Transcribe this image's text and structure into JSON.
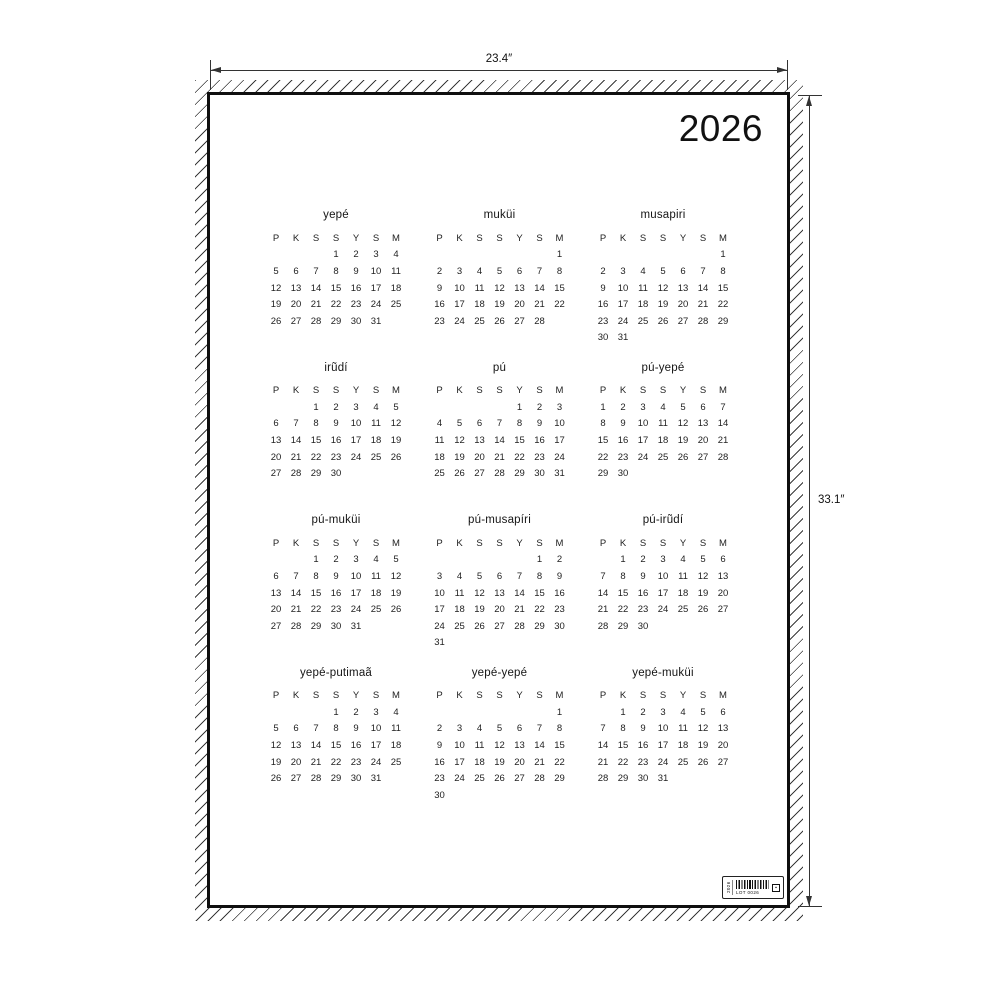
{
  "dimension_annotations": {
    "width_label": "23.4″",
    "height_label": "33.1″"
  },
  "poster": {
    "year": "2026",
    "weekday_headers": [
      "P",
      "K",
      "S",
      "S",
      "Y",
      "S",
      "M"
    ],
    "months": [
      {
        "name": "yepé",
        "weeks": [
          [
            "",
            "",
            "",
            "1",
            "2",
            "3",
            "4"
          ],
          [
            "5",
            "6",
            "7",
            "8",
            "9",
            "10",
            "11"
          ],
          [
            "12",
            "13",
            "14",
            "15",
            "16",
            "17",
            "18"
          ],
          [
            "19",
            "20",
            "21",
            "22",
            "23",
            "24",
            "25"
          ],
          [
            "26",
            "27",
            "28",
            "29",
            "30",
            "31",
            ""
          ]
        ]
      },
      {
        "name": "muküi",
        "weeks": [
          [
            "",
            "",
            "",
            "",
            "",
            "",
            "1"
          ],
          [
            "2",
            "3",
            "4",
            "5",
            "6",
            "7",
            "8"
          ],
          [
            "9",
            "10",
            "11",
            "12",
            "13",
            "14",
            "15"
          ],
          [
            "16",
            "17",
            "18",
            "19",
            "20",
            "21",
            "22"
          ],
          [
            "23",
            "24",
            "25",
            "26",
            "27",
            "28",
            ""
          ]
        ]
      },
      {
        "name": "musapiri",
        "weeks": [
          [
            "",
            "",
            "",
            "",
            "",
            "",
            "1"
          ],
          [
            "2",
            "3",
            "4",
            "5",
            "6",
            "7",
            "8"
          ],
          [
            "9",
            "10",
            "11",
            "12",
            "13",
            "14",
            "15"
          ],
          [
            "16",
            "17",
            "18",
            "19",
            "20",
            "21",
            "22"
          ],
          [
            "23",
            "24",
            "25",
            "26",
            "27",
            "28",
            "29"
          ],
          [
            "30",
            "31",
            "",
            "",
            "",
            "",
            ""
          ]
        ]
      },
      {
        "name": "irũdí",
        "weeks": [
          [
            "",
            "",
            "1",
            "2",
            "3",
            "4",
            "5"
          ],
          [
            "6",
            "7",
            "8",
            "9",
            "10",
            "11",
            "12"
          ],
          [
            "13",
            "14",
            "15",
            "16",
            "17",
            "18",
            "19"
          ],
          [
            "20",
            "21",
            "22",
            "23",
            "24",
            "25",
            "26"
          ],
          [
            "27",
            "28",
            "29",
            "30",
            "",
            "",
            ""
          ]
        ]
      },
      {
        "name": "pú",
        "weeks": [
          [
            "",
            "",
            "",
            "",
            "1",
            "2",
            "3"
          ],
          [
            "4",
            "5",
            "6",
            "7",
            "8",
            "9",
            "10"
          ],
          [
            "11",
            "12",
            "13",
            "14",
            "15",
            "16",
            "17"
          ],
          [
            "18",
            "19",
            "20",
            "21",
            "22",
            "23",
            "24"
          ],
          [
            "25",
            "26",
            "27",
            "28",
            "29",
            "30",
            "31"
          ]
        ]
      },
      {
        "name": "pú-yepé",
        "weeks": [
          [
            "1",
            "2",
            "3",
            "4",
            "5",
            "6",
            "7"
          ],
          [
            "8",
            "9",
            "10",
            "11",
            "12",
            "13",
            "14"
          ],
          [
            "15",
            "16",
            "17",
            "18",
            "19",
            "20",
            "21"
          ],
          [
            "22",
            "23",
            "24",
            "25",
            "26",
            "27",
            "28"
          ],
          [
            "29",
            "30",
            "",
            "",
            "",
            "",
            ""
          ]
        ]
      },
      {
        "name": "pú-muküi",
        "weeks": [
          [
            "",
            "",
            "1",
            "2",
            "3",
            "4",
            "5"
          ],
          [
            "6",
            "7",
            "8",
            "9",
            "10",
            "11",
            "12"
          ],
          [
            "13",
            "14",
            "15",
            "16",
            "17",
            "18",
            "19"
          ],
          [
            "20",
            "21",
            "22",
            "23",
            "24",
            "25",
            "26"
          ],
          [
            "27",
            "28",
            "29",
            "30",
            "31",
            "",
            ""
          ]
        ]
      },
      {
        "name": "pú-musapíri",
        "weeks": [
          [
            "",
            "",
            "",
            "",
            "",
            "1",
            "2"
          ],
          [
            "3",
            "4",
            "5",
            "6",
            "7",
            "8",
            "9"
          ],
          [
            "10",
            "11",
            "12",
            "13",
            "14",
            "15",
            "16"
          ],
          [
            "17",
            "18",
            "19",
            "20",
            "21",
            "22",
            "23"
          ],
          [
            "24",
            "25",
            "26",
            "27",
            "28",
            "29",
            "30"
          ],
          [
            "31",
            "",
            "",
            "",
            "",
            "",
            ""
          ]
        ]
      },
      {
        "name": "pú-irũdí",
        "weeks": [
          [
            "",
            "1",
            "2",
            "3",
            "4",
            "5",
            "6"
          ],
          [
            "7",
            "8",
            "9",
            "10",
            "11",
            "12",
            "13"
          ],
          [
            "14",
            "15",
            "16",
            "17",
            "18",
            "19",
            "20"
          ],
          [
            "21",
            "22",
            "23",
            "24",
            "25",
            "26",
            "27"
          ],
          [
            "28",
            "29",
            "30",
            "",
            "",
            "",
            ""
          ]
        ]
      },
      {
        "name": "yepé-putimaã",
        "weeks": [
          [
            "",
            "",
            "",
            "1",
            "2",
            "3",
            "4"
          ],
          [
            "5",
            "6",
            "7",
            "8",
            "9",
            "10",
            "11"
          ],
          [
            "12",
            "13",
            "14",
            "15",
            "16",
            "17",
            "18"
          ],
          [
            "19",
            "20",
            "21",
            "22",
            "23",
            "24",
            "25"
          ],
          [
            "26",
            "27",
            "28",
            "29",
            "30",
            "31",
            ""
          ]
        ]
      },
      {
        "name": "yepé-yepé",
        "weeks": [
          [
            "",
            "",
            "",
            "",
            "",
            "",
            "1"
          ],
          [
            "2",
            "3",
            "4",
            "5",
            "6",
            "7",
            "8"
          ],
          [
            "9",
            "10",
            "11",
            "12",
            "13",
            "14",
            "15"
          ],
          [
            "16",
            "17",
            "18",
            "19",
            "20",
            "21",
            "22"
          ],
          [
            "23",
            "24",
            "25",
            "26",
            "27",
            "28",
            "29"
          ],
          [
            "30",
            "",
            "",
            "",
            "",
            "",
            ""
          ]
        ]
      },
      {
        "name": "yepé-muküi",
        "weeks": [
          [
            "",
            "1",
            "2",
            "3",
            "4",
            "5",
            "6"
          ],
          [
            "7",
            "8",
            "9",
            "10",
            "11",
            "12",
            "13"
          ],
          [
            "14",
            "15",
            "16",
            "17",
            "18",
            "19",
            "20"
          ],
          [
            "21",
            "22",
            "23",
            "24",
            "25",
            "26",
            "27"
          ],
          [
            "28",
            "29",
            "30",
            "31",
            "",
            "",
            ""
          ]
        ]
      }
    ],
    "product_label": {
      "side_text": "2026",
      "lot_text": "LOT 0026",
      "box_glyph": "▪"
    }
  },
  "colors": {
    "ink": "#1a1a1a",
    "line": "#333333",
    "background": "#ffffff"
  }
}
